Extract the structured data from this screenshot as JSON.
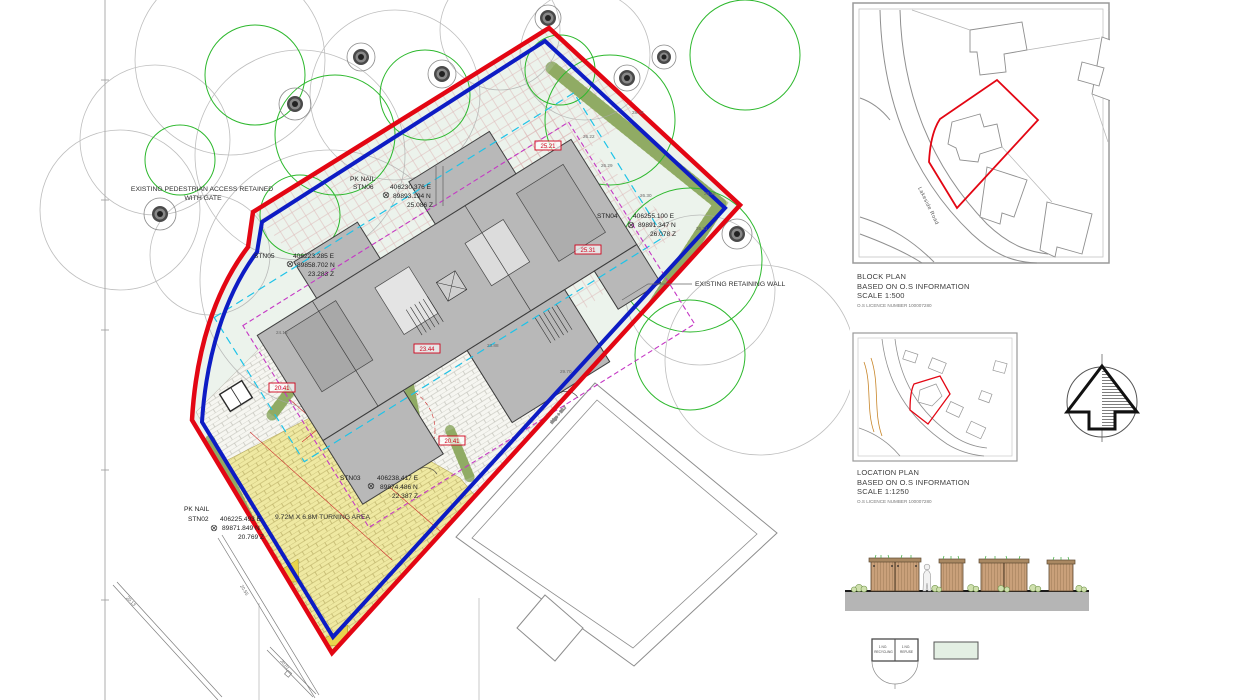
{
  "main_plan": {
    "labels": {
      "pedestrian_access_line1": "EXISTING PEDESTRIAN ACCESS RETAINED",
      "pedestrian_access_line2": "WITH GATE",
      "retaining_wall": "EXISTING RETAINING WALL",
      "turning_area": "9.72M X 6.8M TURNING AREA",
      "ridge_label": "ridge + 30.7"
    },
    "stations": [
      {
        "prefix": "PK NAIL",
        "name": "STN06",
        "easting": "406230.376 E",
        "northing": "89893.194 N",
        "height": "25.086 Z"
      },
      {
        "prefix": "",
        "name": "STN04",
        "easting": "406255.100 E",
        "northing": "89891.347 N",
        "height": "26.078 Z"
      },
      {
        "prefix": "",
        "name": "STN05",
        "easting": "406223.285 E",
        "northing": "89858.702 N",
        "height": "23.283 Z"
      },
      {
        "prefix": "",
        "name": "STN03",
        "easting": "406238.417 E",
        "northing": "89874.486 N",
        "height": "22.387 Z"
      },
      {
        "prefix": "PK NAIL",
        "name": "STN02",
        "easting": "406225.493 E",
        "northing": "89871.849 N",
        "height": "20.769 Z"
      }
    ],
    "level_markers": [
      "25.21",
      "25.31",
      "23.44",
      "20.41",
      "20.41"
    ],
    "spot_levels": [
      "28.42",
      "26.22",
      "26.29",
      "26.30",
      "28.58",
      "26.21",
      "24.15",
      "23.88",
      "29.70",
      "20.13",
      "20.55",
      "20.01"
    ]
  },
  "block_plan": {
    "road_label": "Lakeside Road",
    "caption_title": "BLOCK PLAN",
    "caption_line2": "BASED ON O.S INFORMATION",
    "caption_scale": "SCALE 1:500",
    "caption_licence": "O.S LICENCE NUMBER 100007280"
  },
  "location_plan": {
    "caption_title": "LOCATION PLAN",
    "caption_line2": "BASED ON O.S INFORMATION",
    "caption_scale": "SCALE 1:1250",
    "caption_licence": "O.S LICENCE NUMBER 100007280"
  },
  "bin_store_plan": {
    "cell1_line1": "1 NO.",
    "cell1_line2": "RECYCLING",
    "cell2_line1": "1 NO.",
    "cell2_line2": "REFUSE"
  },
  "colors": {
    "boundary_red": "#e30613",
    "boundary_blue": "#0d1cc4",
    "site_green": "#ecf3ec",
    "building_grey": "#b8b8b8",
    "hedge_green": "#bccb92",
    "paving_yellow": "#efe9a2",
    "timber_tan": "#c9a07a"
  }
}
